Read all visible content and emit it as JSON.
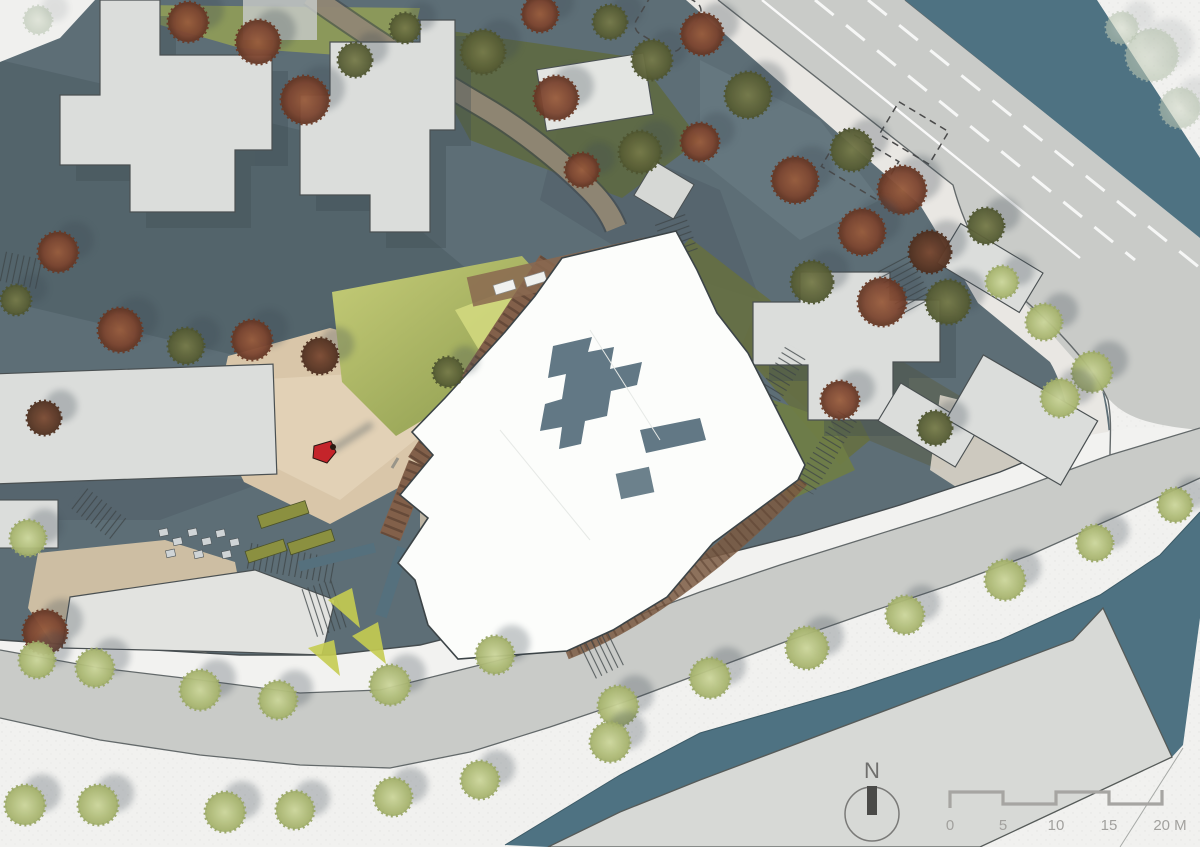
{
  "north_indicator": {
    "label": "N"
  },
  "scale_bar": {
    "tick_labels": [
      "0",
      "5",
      "10",
      "15",
      "20 M"
    ],
    "unit": "M",
    "segment_meters": 5,
    "total_meters": 20
  },
  "palette": {
    "paper": "#f1f1ef",
    "water": "#4e7282",
    "road": "#c9cbc8",
    "site_ground": "#5d6e76",
    "sidewalk": "#f3f3f1",
    "context_building": "#dbdddb",
    "proposed_roof": "#fcfdfb",
    "courtyard_slate": "#5c7380",
    "plaza_tan": "#d9c6a9",
    "green_slope": "#a8b25c",
    "wood_deck": "#82604a",
    "tree_rust": "#8a4c31",
    "tree_olive": "#6d7347",
    "tree_pale": "#c3cf92",
    "figure_red": "#c4242a",
    "scale_gray": "#a6a5a2"
  },
  "trees": [
    [
      38,
      20,
      14,
      "sage"
    ],
    [
      188,
      22,
      20,
      "rust"
    ],
    [
      258,
      42,
      22,
      "rust"
    ],
    [
      305,
      100,
      24,
      "rust"
    ],
    [
      355,
      60,
      17,
      "olive"
    ],
    [
      405,
      28,
      15,
      "olive"
    ],
    [
      483,
      52,
      22,
      "olive"
    ],
    [
      540,
      14,
      18,
      "rust"
    ],
    [
      556,
      98,
      22,
      "rust"
    ],
    [
      610,
      22,
      17,
      "olive"
    ],
    [
      652,
      60,
      20,
      "olive"
    ],
    [
      702,
      34,
      21,
      "rust"
    ],
    [
      748,
      95,
      23,
      "olive"
    ],
    [
      700,
      142,
      19,
      "rust"
    ],
    [
      640,
      152,
      21,
      "olive"
    ],
    [
      582,
      170,
      17,
      "rust"
    ],
    [
      795,
      180,
      23,
      "rust"
    ],
    [
      852,
      150,
      21,
      "olive"
    ],
    [
      902,
      190,
      24,
      "rust"
    ],
    [
      862,
      232,
      23,
      "rust"
    ],
    [
      930,
      252,
      21,
      "brown"
    ],
    [
      986,
      226,
      18,
      "olive"
    ],
    [
      812,
      282,
      21,
      "olive"
    ],
    [
      882,
      302,
      24,
      "rust"
    ],
    [
      948,
      302,
      22,
      "olive"
    ],
    [
      1002,
      282,
      16,
      "pale"
    ],
    [
      1044,
      322,
      18,
      "pale"
    ],
    [
      1092,
      372,
      20,
      "pale"
    ],
    [
      1060,
      398,
      19,
      "pale"
    ],
    [
      58,
      252,
      20,
      "rust"
    ],
    [
      16,
      300,
      15,
      "olive"
    ],
    [
      120,
      330,
      22,
      "rust"
    ],
    [
      186,
      346,
      18,
      "olive"
    ],
    [
      252,
      340,
      20,
      "rust"
    ],
    [
      320,
      356,
      18,
      "brown"
    ],
    [
      44,
      418,
      17,
      "brown"
    ],
    [
      448,
      372,
      15,
      "olive"
    ],
    [
      28,
      538,
      18,
      "pale"
    ],
    [
      45,
      632,
      22,
      "rust"
    ],
    [
      840,
      400,
      19,
      "rust"
    ],
    [
      935,
      428,
      17,
      "olive"
    ],
    [
      37,
      660,
      18,
      "pale"
    ],
    [
      95,
      668,
      19,
      "pale"
    ],
    [
      200,
      690,
      20,
      "pale"
    ],
    [
      278,
      700,
      19,
      "pale"
    ],
    [
      390,
      685,
      20,
      "pale"
    ],
    [
      495,
      655,
      19,
      "pale"
    ],
    [
      618,
      706,
      20,
      "pale"
    ],
    [
      710,
      678,
      20,
      "pale"
    ],
    [
      807,
      648,
      21,
      "pale"
    ],
    [
      905,
      615,
      19,
      "pale"
    ],
    [
      1005,
      580,
      20,
      "pale"
    ],
    [
      1095,
      543,
      18,
      "pale"
    ],
    [
      1175,
      505,
      17,
      "pale"
    ],
    [
      25,
      805,
      20,
      "pale"
    ],
    [
      98,
      805,
      20,
      "pale"
    ],
    [
      225,
      812,
      20,
      "pale"
    ],
    [
      295,
      810,
      19,
      "pale"
    ],
    [
      393,
      797,
      19,
      "pale"
    ],
    [
      480,
      780,
      19,
      "pale"
    ],
    [
      610,
      742,
      20,
      "pale"
    ],
    [
      1152,
      55,
      26,
      "sage"
    ],
    [
      1180,
      108,
      20,
      "sage"
    ],
    [
      1122,
      28,
      16,
      "sage"
    ]
  ]
}
